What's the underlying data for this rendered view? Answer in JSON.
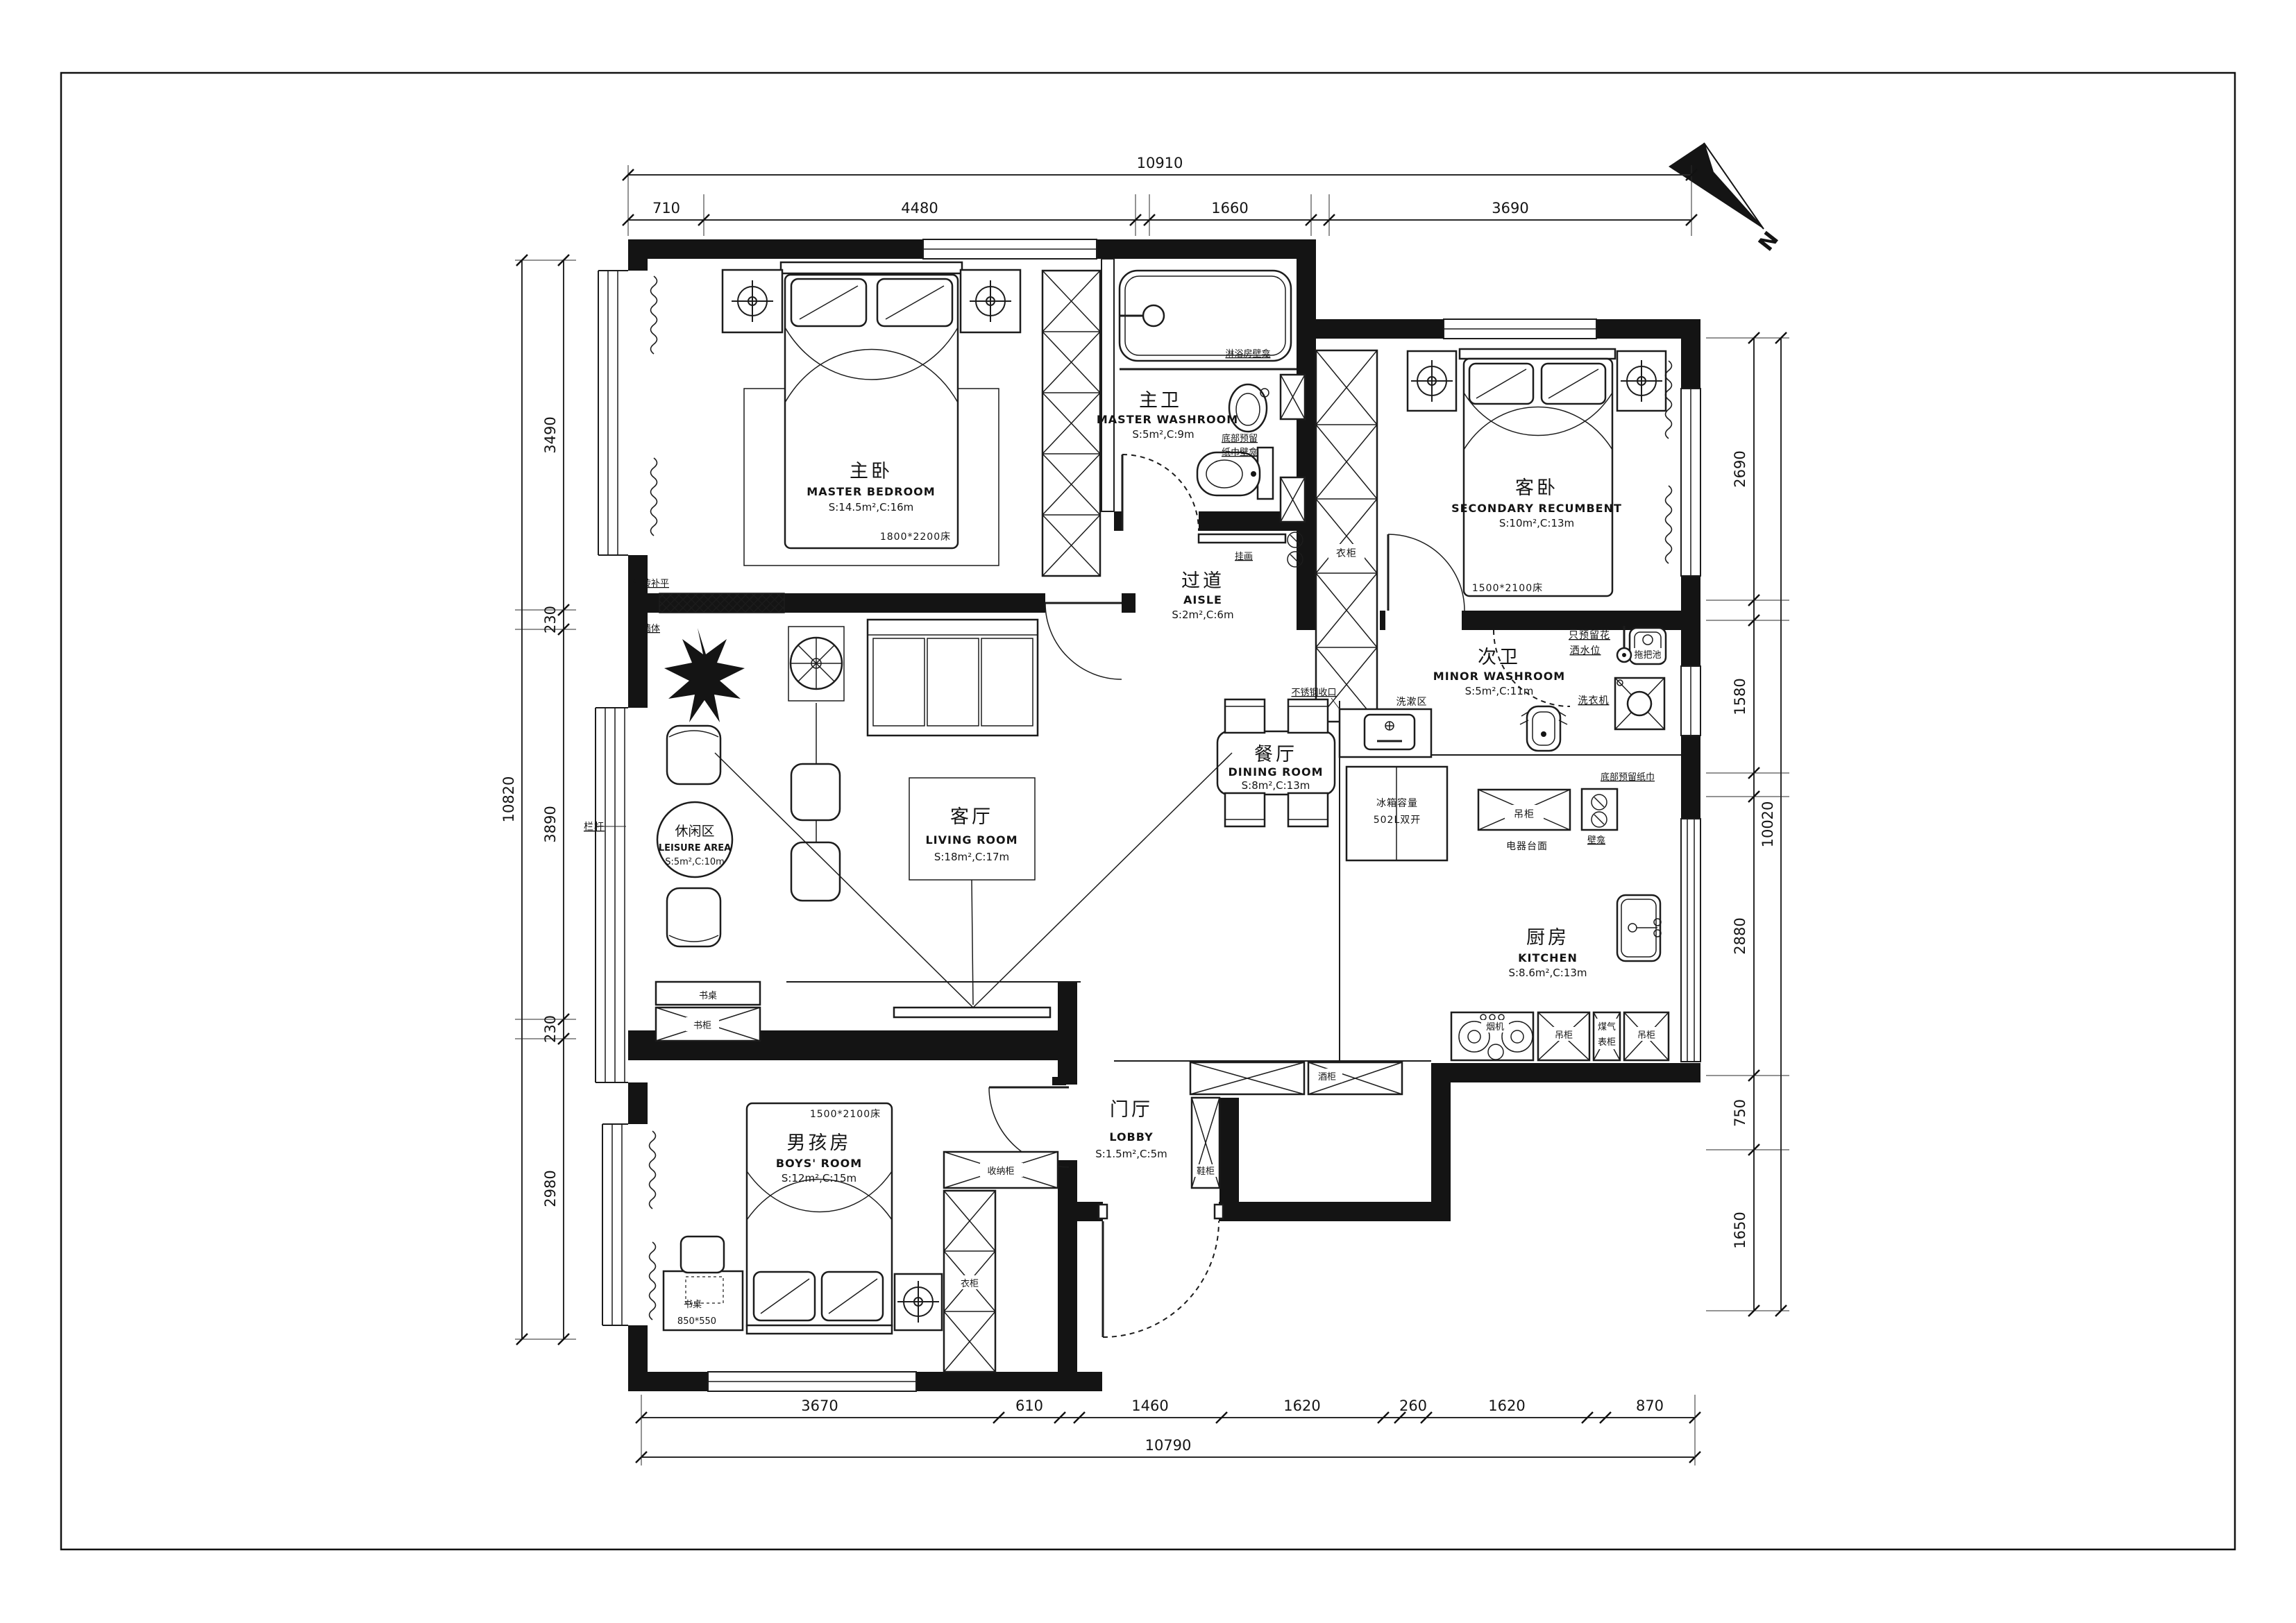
{
  "sheet": {
    "north_label": "N"
  },
  "rooms": {
    "master_bedroom": {
      "cn": "主卧",
      "en": "MASTER BEDROOM",
      "area": "S:14.5m²,C:16m"
    },
    "master_washroom": {
      "cn": "主卫",
      "en": "MASTER WASHROOM",
      "area": "S:5m²,C:9m"
    },
    "aisle": {
      "cn": "过道",
      "en": "AISLE",
      "area": "S:2m²,C:6m"
    },
    "secondary_bedroom": {
      "cn": "客卧",
      "en": "SECONDARY RECUMBENT",
      "area": "S:10m²,C:13m"
    },
    "minor_washroom": {
      "cn": "次卫",
      "en": "MINOR WASHROOM",
      "area": "S:5m²,C:11m"
    },
    "living_room": {
      "cn": "客厅",
      "en": "LIVING ROOM",
      "area": "S:18m²,C:17m"
    },
    "dining_room": {
      "cn": "餐厅",
      "en": "DINING ROOM",
      "area": "S:8m²,C:13m"
    },
    "leisure_area": {
      "cn": "休闲区",
      "en": "LEISURE AREA",
      "area": "S:5m²,C:10m"
    },
    "kitchen": {
      "cn": "厨房",
      "en": "KITCHEN",
      "area": "S:8.6m²,C:13m"
    },
    "lobby": {
      "cn": "门厅",
      "en": "LOBBY",
      "area": "S:1.5m²,C:5m"
    },
    "boys_room": {
      "cn": "男孩房",
      "en": "BOYS' ROOM",
      "area": "S:12m²,C:15m"
    }
  },
  "furniture_labels": {
    "master_bed_size": "1800*2200床",
    "secondary_bed_size": "1500*2100床",
    "boys_bed_size": "1500*2100床",
    "desk": "书桌",
    "desk_size": "850*550",
    "bookcase": "书柜",
    "wardrobe": "衣柜",
    "storage_cabinet": "收纳柜",
    "shoe_cabinet": "鞋柜",
    "wine_cabinet": "酒柜",
    "hanging_cabinet": "吊柜",
    "appliance_counter": "电器台面",
    "range_hood": "烟机",
    "gas_meter_line1": "煤气",
    "gas_meter_line2": "表柜",
    "fridge_line1": "冰箱容量",
    "fridge_line2": "502L双开",
    "washing_area": "洗漱区",
    "washing_machine": "洗衣机",
    "mop_pool": "拖把池"
  },
  "notes": {
    "shower_reserve_line1": "只预留花",
    "shower_reserve_line2": "洒水位",
    "tissue_niche_line1": "底部预留",
    "tissue_niche_line2": "纸巾壁龛",
    "tissue_niche2_line1": "底部预留纸巾",
    "tissue_niche2_line2": "壁龛",
    "shower_niche": "淋浴房壁龛",
    "hanging_picture": "挂画",
    "brick_line1": "红砖补平",
    "brick_line2": "墙体",
    "railing": "栏杆",
    "steel_trim": "不锈钢收口"
  },
  "dimensions": {
    "top": {
      "total": "10910",
      "segments": [
        "710",
        "4480",
        "1660",
        "3690"
      ]
    },
    "bottom": {
      "total": "10790",
      "segments": [
        "3670",
        "610",
        "1460",
        "1620",
        "260",
        "1620",
        "870"
      ]
    },
    "left": {
      "total": "10820",
      "segments": [
        "3490",
        "230",
        "3890",
        "230",
        "2980"
      ]
    },
    "right": {
      "total": "10020",
      "segments": [
        "2690",
        "1580",
        "2880",
        "750",
        "1650"
      ]
    }
  }
}
